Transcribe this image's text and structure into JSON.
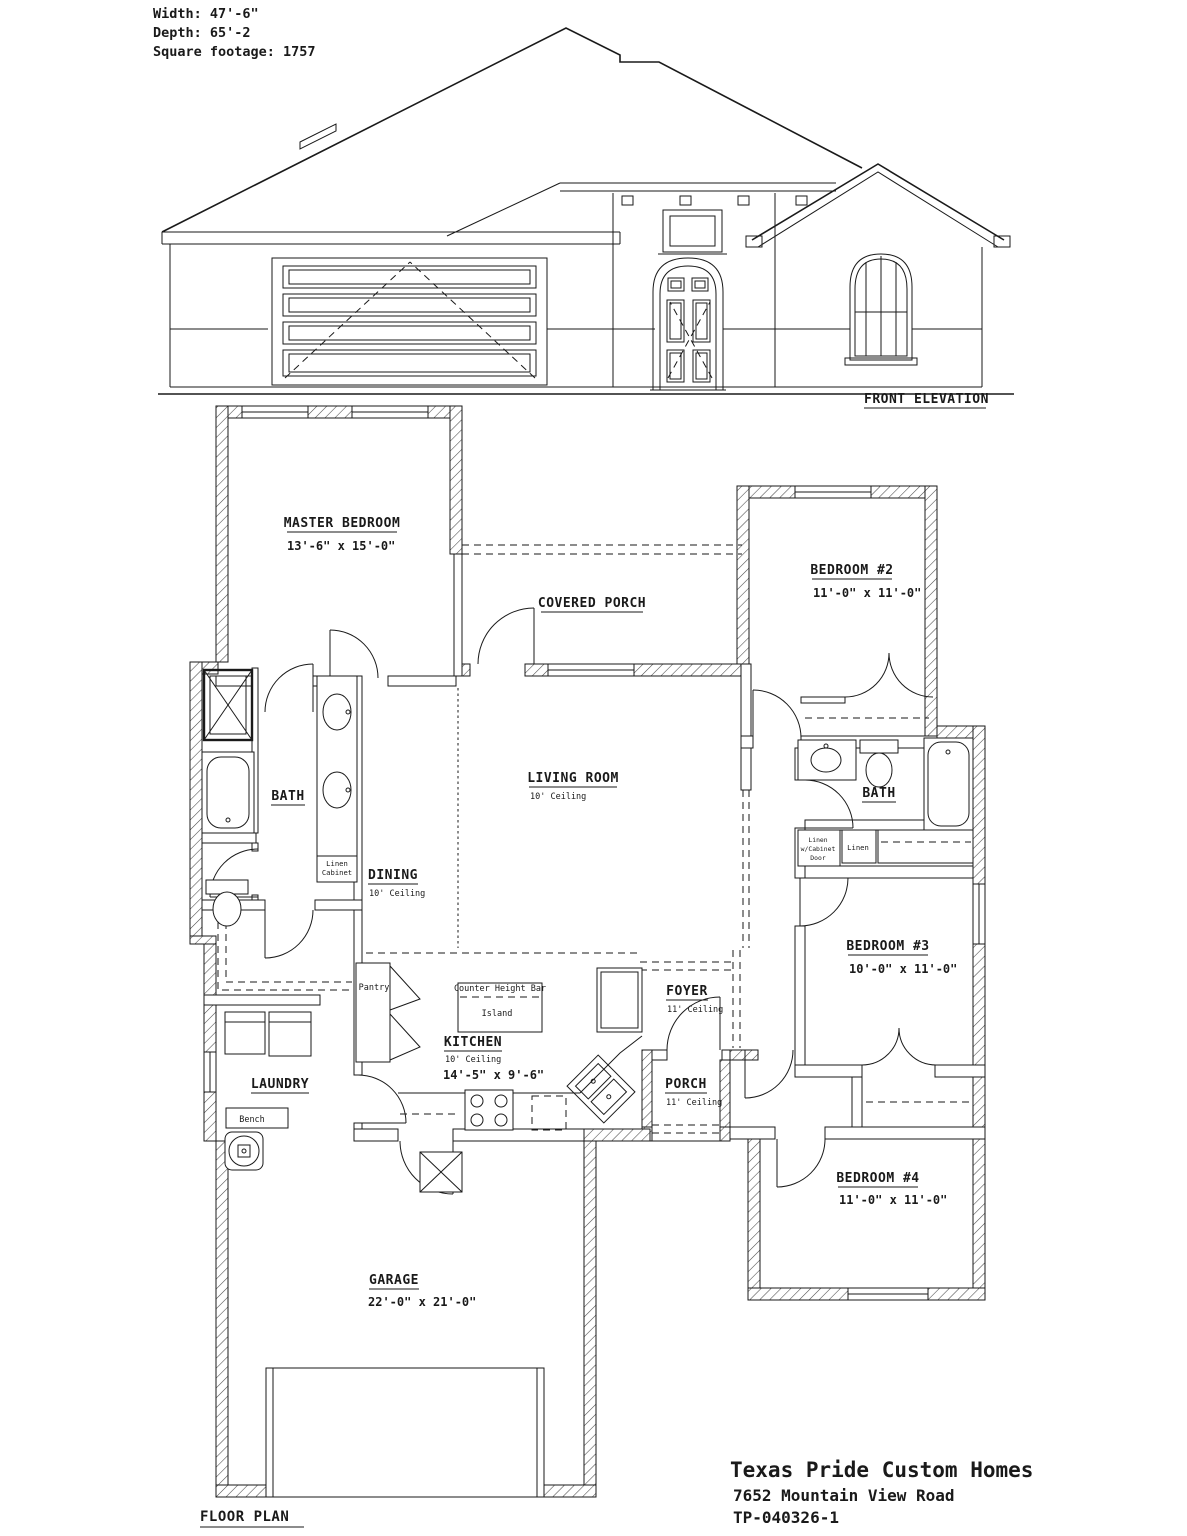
{
  "colors": {
    "line": "#1a1a1a",
    "background": "#ffffff"
  },
  "header": {
    "width": "Width:  47'-6\"",
    "depth": "Depth: 65'-2",
    "square_footage": "Square footage: 1757"
  },
  "elevation": {
    "label": "FRONT ELEVATION"
  },
  "floor_plan": {
    "label": "FLOOR PLAN",
    "rooms": {
      "master_bedroom": {
        "name": "MASTER BEDROOM",
        "dims": "13'-6\" x 15'-0\""
      },
      "covered_porch": {
        "name": "COVERED PORCH"
      },
      "bedroom_2": {
        "name": "BEDROOM #2",
        "dims": "11'-0\" x 11'-0\""
      },
      "living_room": {
        "name": "LIVING ROOM",
        "ceiling": "10' Ceiling"
      },
      "dining": {
        "name": "DINING",
        "ceiling": "10' Ceiling"
      },
      "bath_master": {
        "name": "BATH"
      },
      "bath_2": {
        "name": "BATH"
      },
      "bedroom_3": {
        "name": "BEDROOM #3",
        "dims": "10'-0\" x 11'-0\""
      },
      "bedroom_4": {
        "name": "BEDROOM #4",
        "dims": "11'-0\" x 11'-0\""
      },
      "kitchen": {
        "name": "KITCHEN",
        "ceiling": "10' Ceiling",
        "dims": "14'-5\" x 9'-6\""
      },
      "foyer": {
        "name": "FOYER",
        "ceiling": "11' Ceiling"
      },
      "porch": {
        "name": "PORCH",
        "ceiling": "11' Ceiling"
      },
      "laundry": {
        "name": "LAUNDRY"
      },
      "garage": {
        "name": "GARAGE",
        "dims": "22'-0\" x 21'-0\""
      }
    },
    "annotations": {
      "pantry": "Pantry",
      "counter_height_bar": "Counter Height Bar",
      "island": "Island",
      "bench": "Bench",
      "linen_cabinet_line1": "Linen",
      "linen_cabinet_line2": "Cabinet",
      "linen": "Linen",
      "linen_door_line1": "Linen",
      "linen_door_line2": "w/Cabinet",
      "linen_door_line3": "Door"
    }
  },
  "title_block": {
    "company": "Texas Pride Custom Homes",
    "address": "7652 Mountain View Road",
    "plan_number": "TP-040326-1"
  }
}
